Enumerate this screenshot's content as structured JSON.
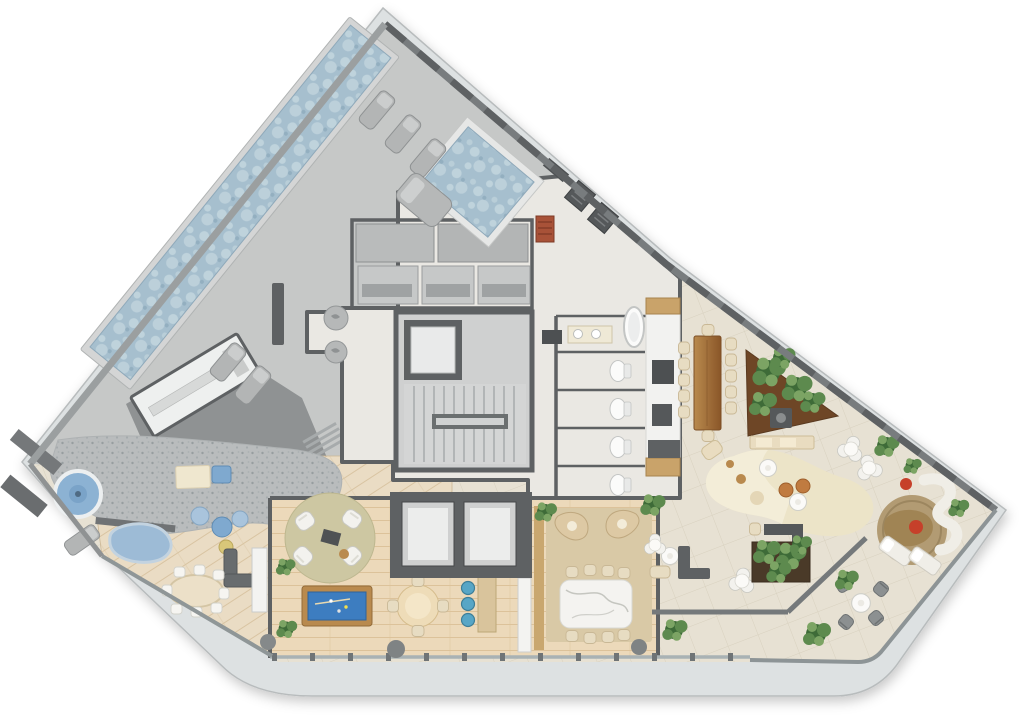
{
  "meta": {
    "type": "architectural-floor-plan",
    "view": "top-down-render",
    "width_px": 1024,
    "height_px": 721,
    "visible_text": "none"
  },
  "palette": {
    "page_bg": "#ffffff",
    "slab": "#dde1e2",
    "slab_edge": "#b8bcbd",
    "deck": "#c6c8c7",
    "deck_light": "#d4d5d5",
    "roof": "#8f9293",
    "wall": "#5e6163",
    "wall_mid": "#75797b",
    "int": "#eae8e3",
    "tile": "#e7e1d3",
    "tile_line": "#d8d1bf",
    "wood_floor": "#ecd9ba",
    "wood_fam": "#eadcc4",
    "wood_deck_line": "#dcc29a",
    "pebble": "#b9bcbd",
    "water": "#a6bfce",
    "water_light": "#c6d8e0",
    "spa_water": "#8cb2d3",
    "pool_felt": "#3d7dc0",
    "wood_brown": "#b98a4e",
    "table_wood_dark": "#8a5628",
    "marble": "#f4f3f0",
    "rug_cream": "#ece4c8",
    "rug_tan": "#d9c9a6",
    "rug_round": "#cdc7a2",
    "jute": "#b29b73",
    "plant_dark": "#3e6b38",
    "plant_mid": "#5d8a4e",
    "plant_light": "#7ca464",
    "chair_white": "#f3f2ee",
    "chair_beige": "#e7dcc2",
    "pouf_blue": "#7fa9cf",
    "pouf_blue_light": "#a9c4dc",
    "stool_blue": "#58a6c6",
    "pouf_orange": "#c07b40",
    "accent_red": "#c6402a",
    "glass": "#a9b2b4"
  },
  "regions": [
    {
      "id": "lap-pool",
      "fill": "water"
    },
    {
      "id": "plunge-pool",
      "fill": "water"
    },
    {
      "id": "sun-deck",
      "fill": "deck"
    },
    {
      "id": "service-roof",
      "fill": "roof"
    },
    {
      "id": "changing-room",
      "fill": "int"
    },
    {
      "id": "sauna-steam-rooms",
      "fill": "deck"
    },
    {
      "id": "laundry",
      "fill": "int"
    },
    {
      "id": "stair-core",
      "fill": "deck_light"
    },
    {
      "id": "elevator",
      "fill": "int"
    },
    {
      "id": "restrooms",
      "fill": "int"
    },
    {
      "id": "kitchen-pantry",
      "fill": "int"
    },
    {
      "id": "spa-pool",
      "fill": "spa_water"
    },
    {
      "id": "splash-water-feature",
      "fill": "spa_water"
    },
    {
      "id": "pebble-deck",
      "fill": "pebble"
    },
    {
      "id": "family-lounge",
      "fill": "wood_fam"
    },
    {
      "id": "games-room",
      "fill": "wood_floor"
    },
    {
      "id": "billiards-table",
      "fill": "pool_felt"
    },
    {
      "id": "bar-counter",
      "fill": "wood_brown"
    },
    {
      "id": "elevator-bank",
      "fill": "wall"
    },
    {
      "id": "private-dining",
      "fill": "wood_floor"
    },
    {
      "id": "marble-dining-table",
      "fill": "marble"
    },
    {
      "id": "terrace",
      "fill": "tile"
    },
    {
      "id": "outdoor-dining-table",
      "fill": "table_wood_dark"
    },
    {
      "id": "fire-pit-lounge",
      "fill": "rug_cream"
    },
    {
      "id": "corner-lounge",
      "fill": "jute"
    },
    {
      "id": "planters",
      "fill": "plant_mid"
    }
  ]
}
